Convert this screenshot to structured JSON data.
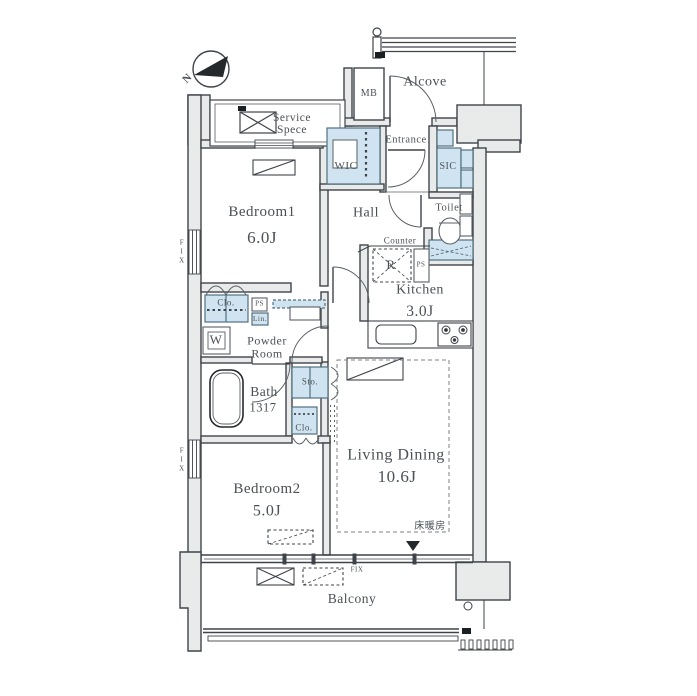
{
  "compass": {
    "north": "N"
  },
  "rooms": {
    "service_space": {
      "line1": "Service",
      "line2": "Spece"
    },
    "alcove": {
      "name": "Alcove"
    },
    "mb": {
      "name": "MB"
    },
    "entrance": {
      "name": "Entrance"
    },
    "wic": {
      "name": "WIC"
    },
    "sic": {
      "name": "SIC"
    },
    "toilet": {
      "name": "Toilet"
    },
    "hall": {
      "name": "Hall"
    },
    "bedroom1": {
      "name": "Bedroom1",
      "size": "6.0J"
    },
    "kitchen": {
      "name": "Kitchen",
      "size": "3.0J",
      "counter": "Counter"
    },
    "powder_room": {
      "line1": "Powder",
      "line2": "Room"
    },
    "bath": {
      "name": "Bath",
      "size": "1317"
    },
    "living_dining": {
      "name": "Living Dining",
      "size": "10.6J",
      "floor_heating": "床暖房"
    },
    "bedroom2": {
      "name": "Bedroom2",
      "size": "5.0J"
    },
    "balcony": {
      "name": "Balcony"
    }
  },
  "fixtures": {
    "clo_upper": "Clo.",
    "clo_lower": "Clo.",
    "sto": "Sto.",
    "lin": "Lin.",
    "ps_powder": "PS",
    "ps_kitchen": "PS",
    "washer": "W",
    "fridge": "R"
  },
  "windows": {
    "fix_left_upper": "FIX",
    "fix_left_lower": "FIX",
    "fix_balcony": "FIX"
  },
  "colors": {
    "fixture_blue": "#cfe4f0",
    "wall_gray": "#e9ebeb",
    "line_dark": "#3f444a",
    "text_gray": "#4b5156"
  }
}
